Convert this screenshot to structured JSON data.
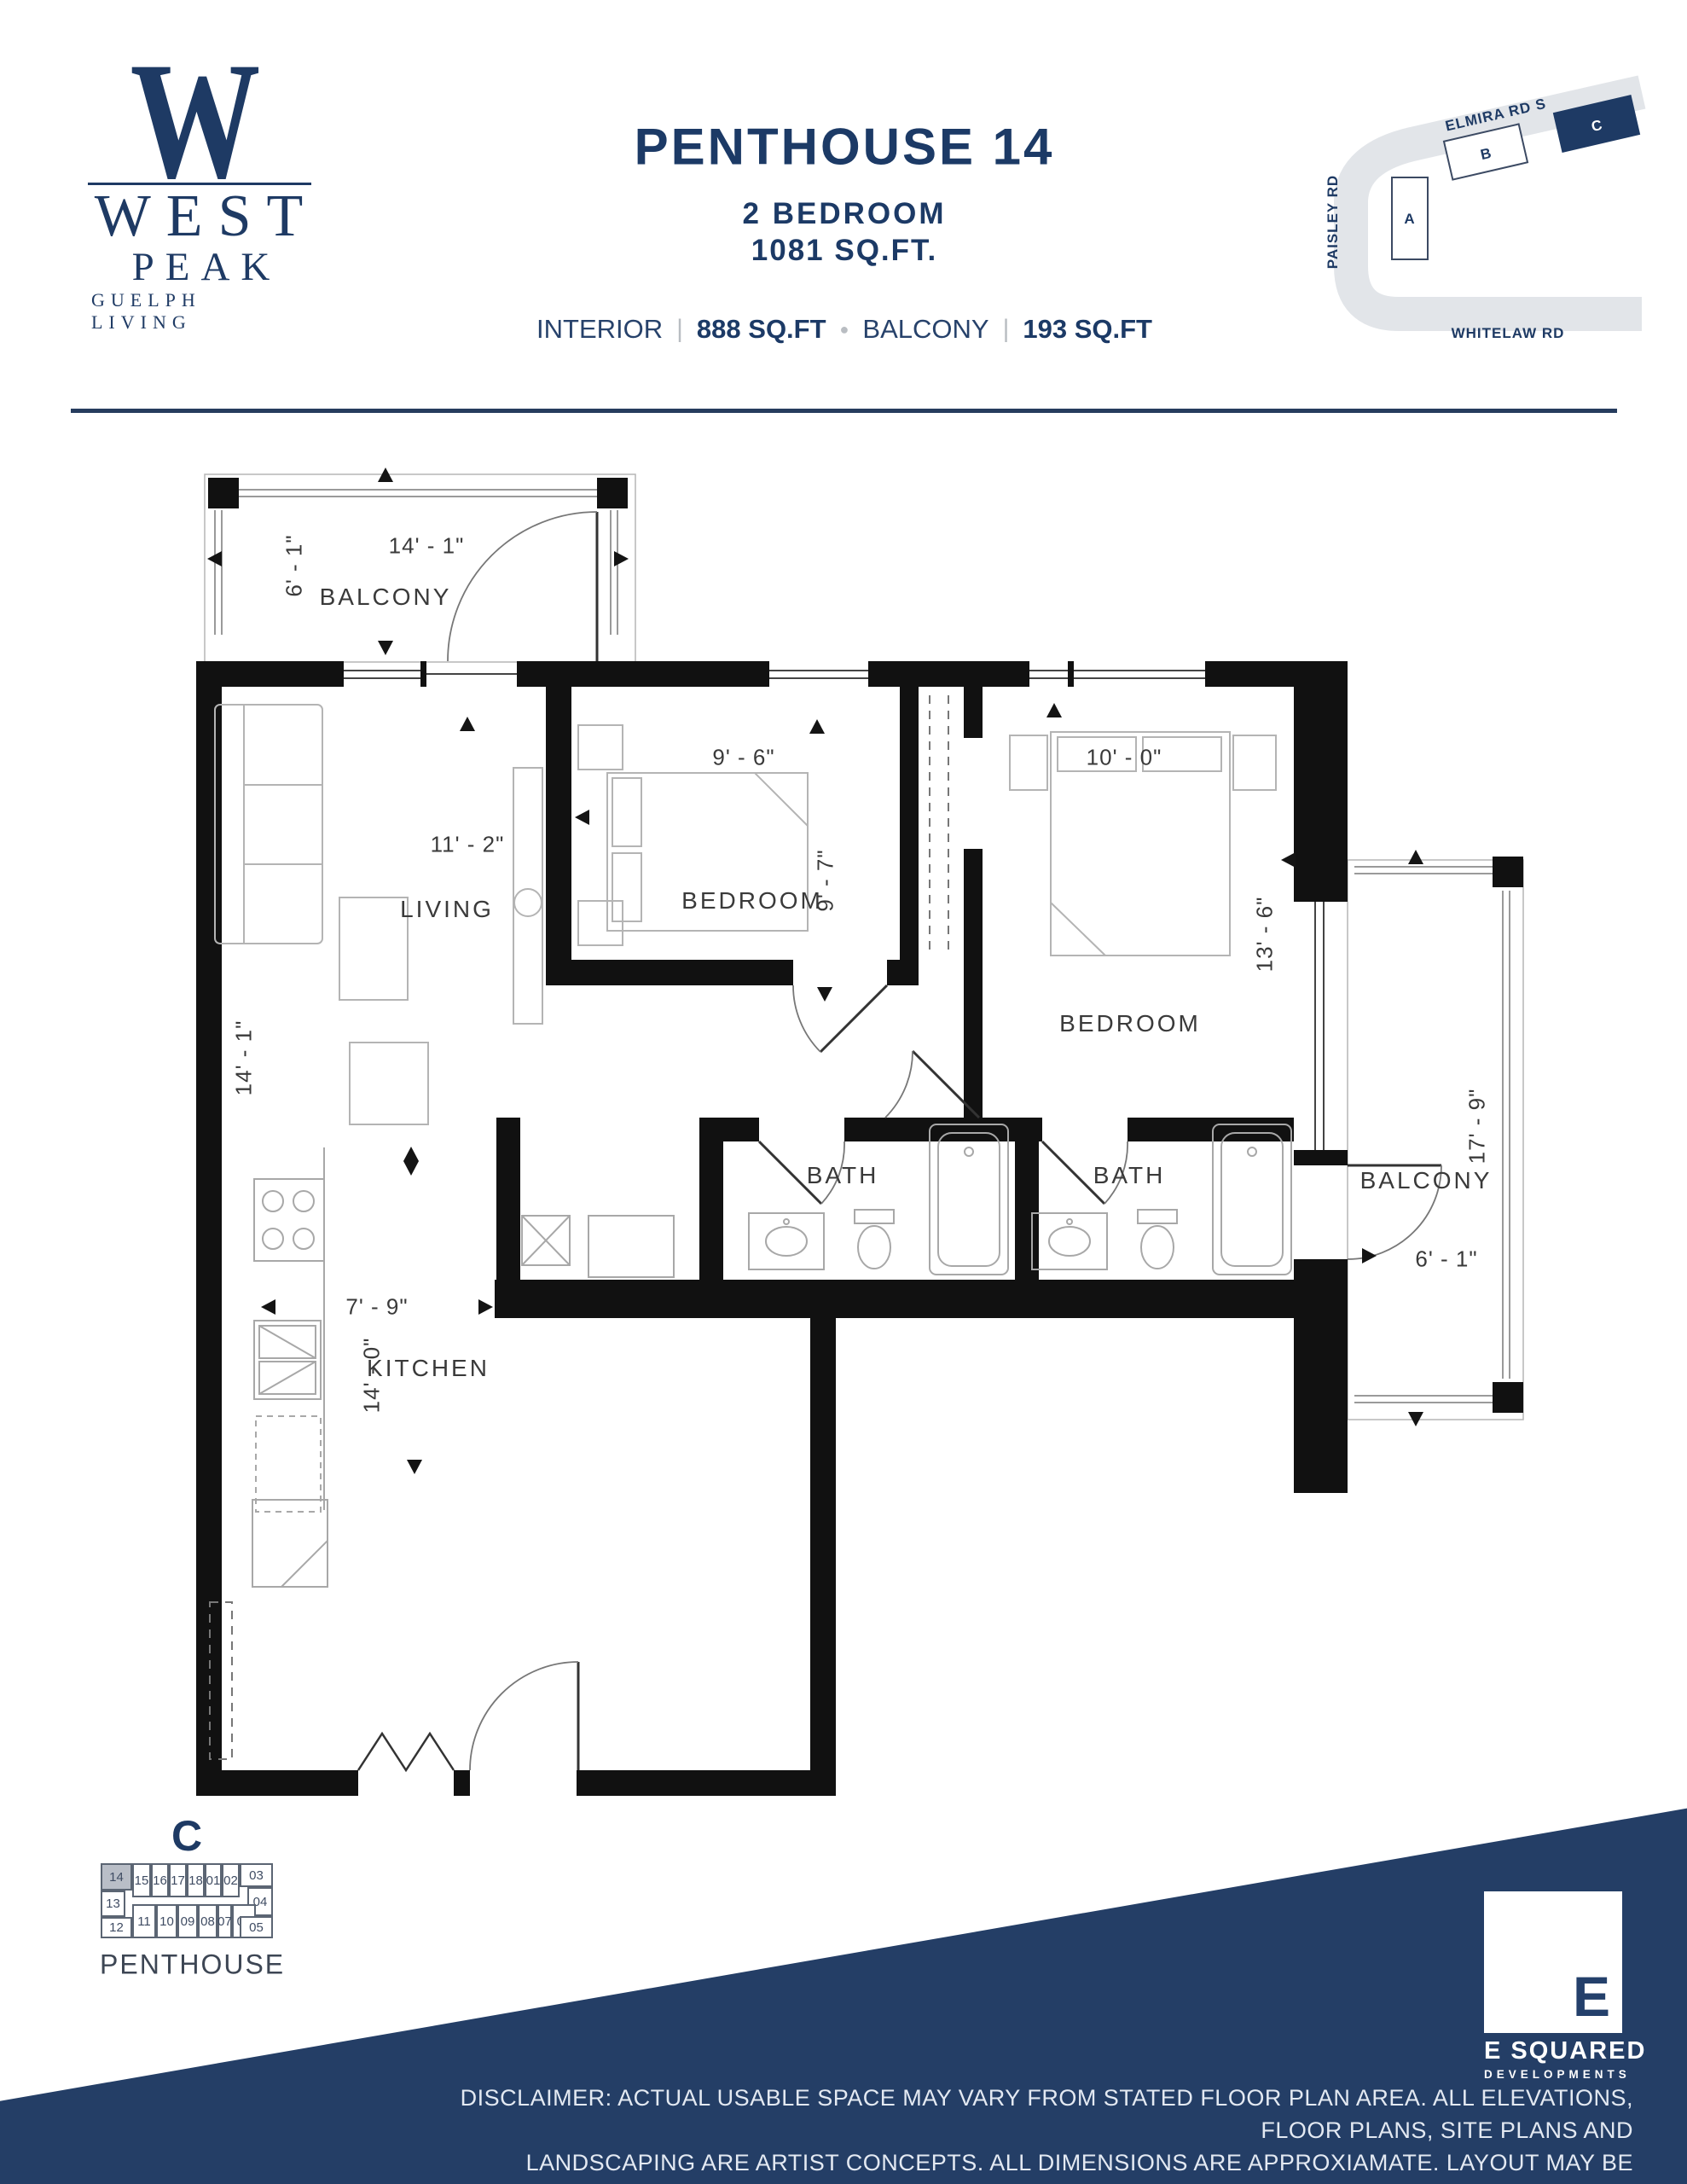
{
  "brand": {
    "monogram": "W",
    "name_line1": "WEST",
    "name_line2": "PEAK",
    "tagline": "GUELPH LIVING"
  },
  "header": {
    "title": "PENTHOUSE 14",
    "subtitle": "2 BEDROOM",
    "total_area": "1081 SQ.FT.",
    "interior_label": "INTERIOR",
    "interior_value": "888 SQ.FT",
    "balcony_label": "BALCONY",
    "balcony_value": "193 SQ.FT",
    "divider": "|",
    "dot": "●"
  },
  "site_map": {
    "roads": [
      "ELMIRA RD S",
      "PAISLEY  RD",
      "WHITELAW RD"
    ],
    "buildings": [
      {
        "id": "A"
      },
      {
        "id": "B"
      },
      {
        "id": "C",
        "highlighted": true
      }
    ]
  },
  "floor_plan": {
    "balcony_tl": {
      "name": "BALCONY",
      "width": "14' - 1\"",
      "depth": "6' - 1\""
    },
    "living": {
      "name": "LIVING",
      "width": "11' - 2\"",
      "depth": "14' - 1\""
    },
    "bedroom1": {
      "name": "BEDROOM",
      "width": "9' - 6\"",
      "depth": "9' - 7\""
    },
    "bedroom2": {
      "name": "BEDROOM",
      "width": "10' - 0\"",
      "depth": "13' - 6\""
    },
    "bath1": {
      "name": "BATH"
    },
    "bath2": {
      "name": "BATH"
    },
    "kitchen": {
      "name": "KITCHEN",
      "width": "7' - 9\"",
      "depth": "14' - 0\""
    },
    "balcony_r": {
      "name": "BALCONY",
      "depth": "17' - 9\"",
      "width": "6' - 1\""
    }
  },
  "key_plan": {
    "building": "C",
    "level_label": "PENTHOUSE",
    "highlight_unit": "14",
    "units": [
      "14",
      "15",
      "16",
      "17",
      "18",
      "01",
      "02",
      "03",
      "04",
      "13",
      "12",
      "11",
      "10",
      "09",
      "08",
      "07",
      "06",
      "05"
    ]
  },
  "footer": {
    "logo_letter": "E",
    "logo_line1": "E SQUARED",
    "logo_line2": "DEVELOPMENTS",
    "disclaimer_lines": [
      "DISCLAIMER: ACTUAL USABLE SPACE MAY VARY FROM STATED FLOOR PLAN AREA. ALL ELEVATIONS, FLOOR PLANS, SITE PLANS AND",
      "LANDSCAPING ARE ARTIST CONCEPTS. ALL DIMENSIONS ARE APPROXIAMATE. LAYOUT MAY BE REVERSE OF THE UNIT PURCHASED.",
      "WINDOW LOCATIONS AND WINDOW TYPES VARY BETWEEN FLOORS. E&OE."
    ]
  },
  "colors": {
    "navy": "#243e66",
    "text_navy": "#1e3a64",
    "wall_black": "#111111",
    "road_gray": "#e2e5e9",
    "highlight_gray": "#b9bec7"
  }
}
